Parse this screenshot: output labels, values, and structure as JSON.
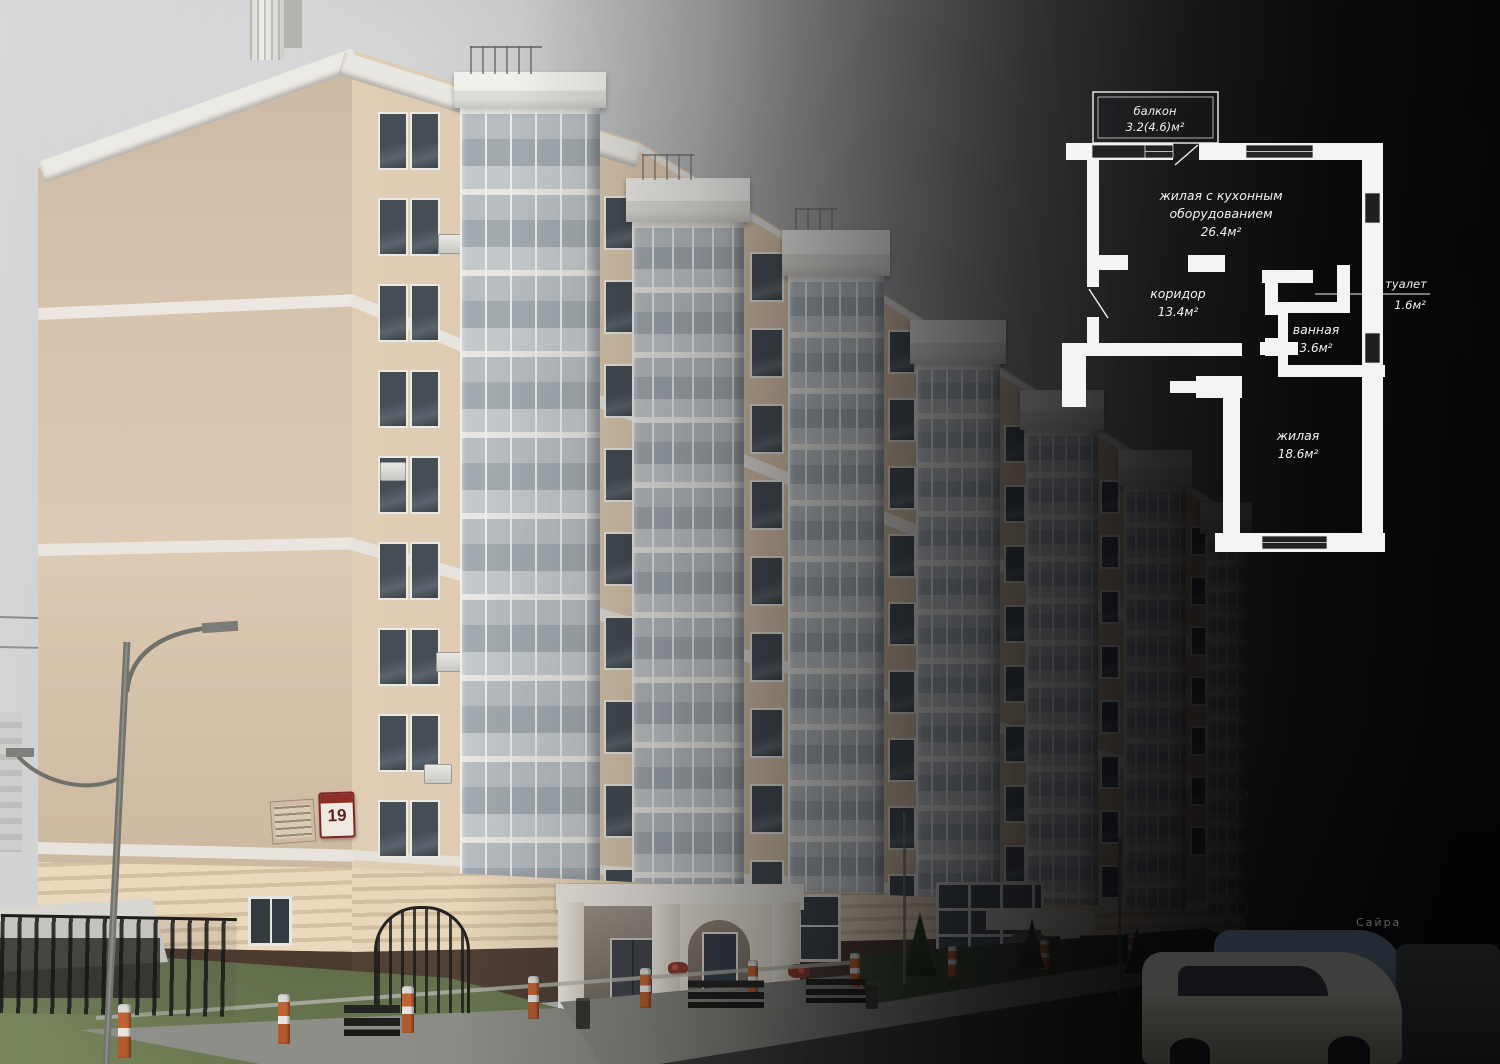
{
  "building": {
    "house_number": "19"
  },
  "background": {
    "storefront_sign": "Сайра"
  },
  "floorplan": {
    "balcony": {
      "label": "балкон",
      "area": "3.2(4.6)м²"
    },
    "living_kitchen": {
      "label_line1": "жилая с кухонным",
      "label_line2": "оборудованием",
      "area": "26.4м²"
    },
    "corridor": {
      "label": "коридор",
      "area": "13.4м²"
    },
    "toilet": {
      "label": "туалет",
      "area": "1.6м²"
    },
    "bathroom": {
      "label": "ванная",
      "area": "3.6м²"
    },
    "living": {
      "label": "жилая",
      "area": "18.6м²"
    }
  },
  "colors": {
    "facade_beige": "#d8c5ab",
    "trim_white": "#ece9e3",
    "plan_wall": "#f4f4f2",
    "bollard_orange": "#c06332",
    "house_sign_red": "#8c2d26",
    "grass_green": "#6a7850",
    "sky_light": "#d4d6d7",
    "overlay_black": "#000000"
  }
}
